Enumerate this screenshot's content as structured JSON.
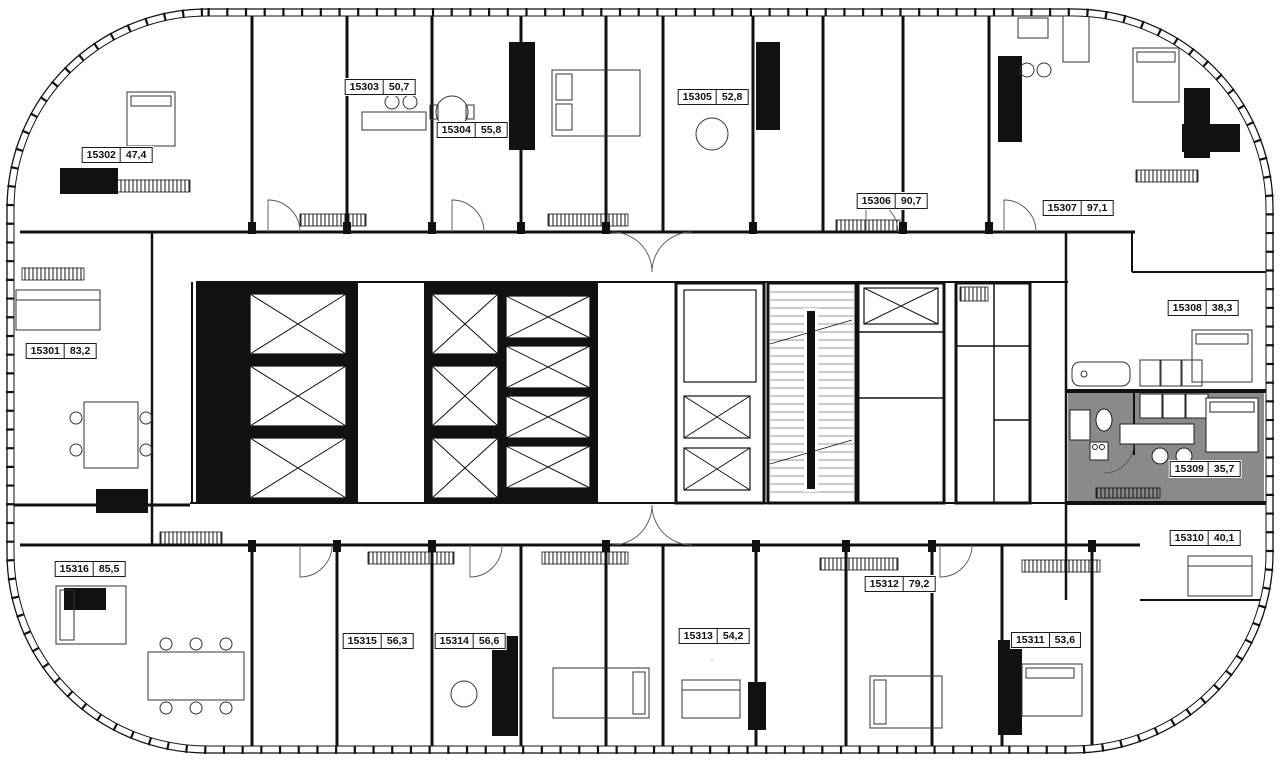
{
  "floorplan": {
    "type": "residential-floor-plan",
    "highlighted_unit_id": "15309",
    "highlight_color": "#8a8a8a",
    "units": [
      {
        "id": "15301",
        "area": "83,2"
      },
      {
        "id": "15302",
        "area": "47,4"
      },
      {
        "id": "15303",
        "area": "50,7"
      },
      {
        "id": "15304",
        "area": "55,8"
      },
      {
        "id": "15305",
        "area": "52,8"
      },
      {
        "id": "15306",
        "area": "90,7"
      },
      {
        "id": "15307",
        "area": "97,1"
      },
      {
        "id": "15308",
        "area": "38,3"
      },
      {
        "id": "15309",
        "area": "35,7"
      },
      {
        "id": "15310",
        "area": "40,1"
      },
      {
        "id": "15311",
        "area": "53,6"
      },
      {
        "id": "15312",
        "area": "79,2"
      },
      {
        "id": "15313",
        "area": "54,2"
      },
      {
        "id": "15314",
        "area": "56,6"
      },
      {
        "id": "15315",
        "area": "56,3"
      },
      {
        "id": "15316",
        "area": "85,5"
      }
    ]
  }
}
